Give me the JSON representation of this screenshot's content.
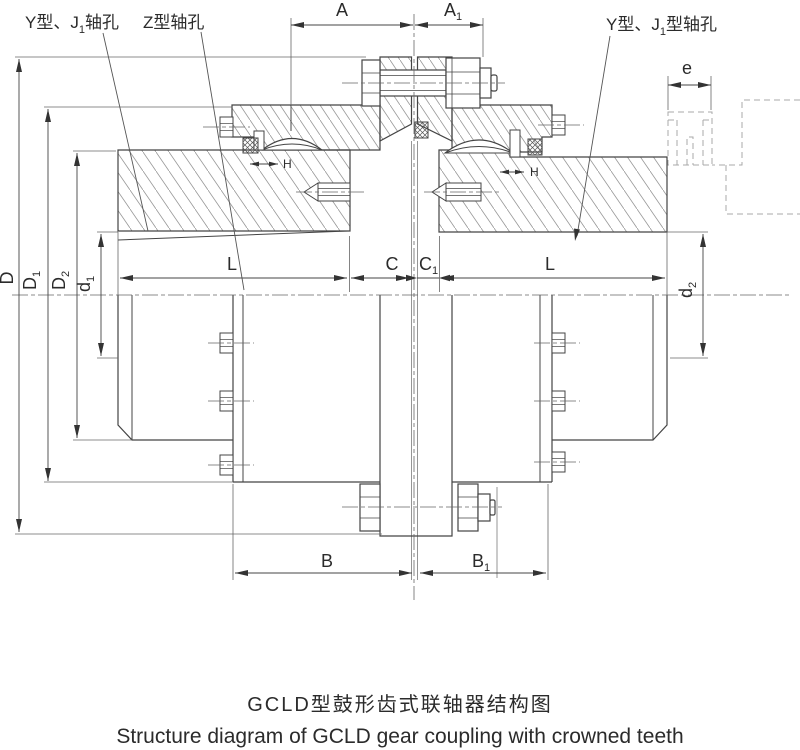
{
  "diagram": {
    "leaders": {
      "left": {
        "p1": "Y型、J",
        "sub": "1",
        "p2": "轴孔"
      },
      "taper": {
        "p1": "Z型轴孔"
      },
      "right": {
        "p1": "Y型、J",
        "sub": "1",
        "p2": "型轴孔"
      }
    },
    "dims": {
      "A": {
        "base": "A",
        "sub": ""
      },
      "A1": {
        "base": "A",
        "sub": "1"
      },
      "e": {
        "base": "e",
        "sub": ""
      },
      "D": {
        "base": "D",
        "sub": ""
      },
      "D1": {
        "base": "D",
        "sub": "1"
      },
      "D2": {
        "base": "D",
        "sub": "2"
      },
      "d1": {
        "base": "d",
        "sub": "1"
      },
      "d2": {
        "base": "d",
        "sub": "2"
      },
      "L": {
        "base": "L",
        "sub": ""
      },
      "C": {
        "base": "C",
        "sub": ""
      },
      "C1": {
        "base": "C",
        "sub": "1"
      },
      "B": {
        "base": "B",
        "sub": ""
      },
      "B1": {
        "base": "B",
        "sub": "1"
      },
      "H": {
        "base": "H",
        "sub": ""
      }
    },
    "captions": {
      "zh": "GCLD型鼓形齿式联轴器结构图",
      "en": "Structure diagram of GCLD gear coupling with crowned teeth"
    }
  }
}
